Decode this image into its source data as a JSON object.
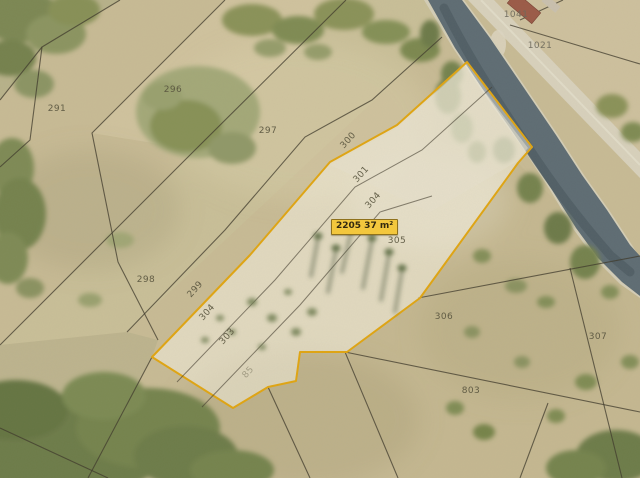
{
  "map": {
    "area_label": "2205 37 m²",
    "labels": [
      {
        "text": "1041"
      },
      {
        "text": "1021"
      },
      {
        "text": "291"
      },
      {
        "text": "296"
      },
      {
        "text": "297"
      },
      {
        "text": "300"
      },
      {
        "text": "301"
      },
      {
        "text": "304"
      },
      {
        "text": "305"
      },
      {
        "text": "299"
      },
      {
        "text": "304"
      },
      {
        "text": "303"
      },
      {
        "text": "298"
      },
      {
        "text": "306"
      },
      {
        "text": "307"
      },
      {
        "text": "803"
      },
      {
        "text": "85"
      }
    ],
    "colors": {
      "highlight_outline": "#e0a512",
      "highlight_fill": "rgba(255,252,242,0.45)",
      "measure_box_bg": "#f3c73d",
      "measure_box_border": "#8f711c",
      "boundary_line": "#3f392b",
      "river_water": "#5e6c73",
      "terrain_base": "#c8bb95"
    }
  }
}
